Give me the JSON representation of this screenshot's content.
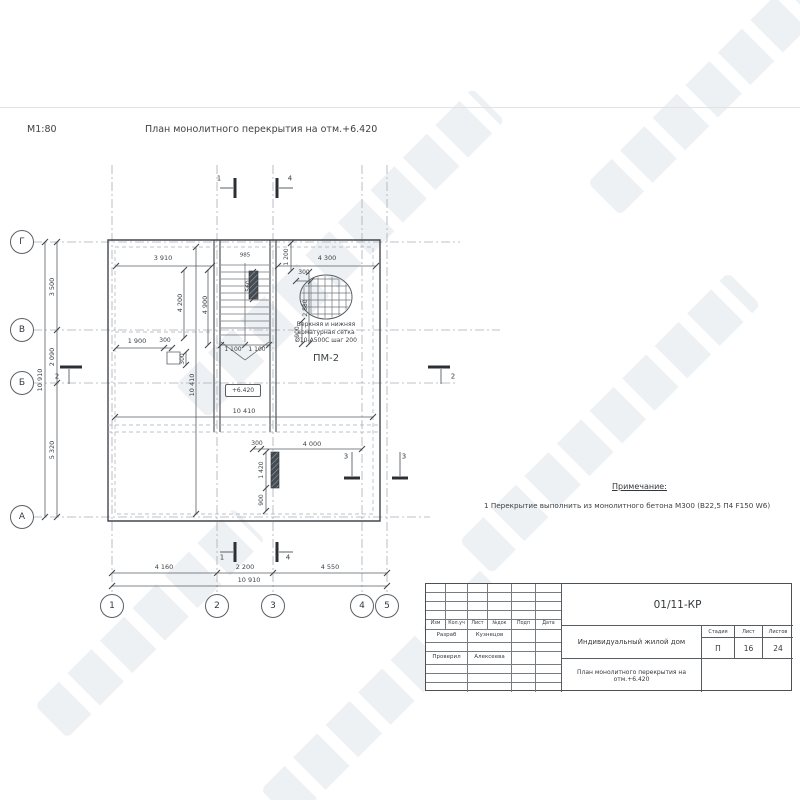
{
  "page": {
    "scale_label": "М1:80",
    "title": "План монолитного перекрытия на отм.+6.420"
  },
  "mesh_note": {
    "line1": "Верхняя и нижняя",
    "line2": "арматурная сетка",
    "line3": "Ø10-А500С шаг 200",
    "mark": "ПМ-2"
  },
  "elevation_mark": "+6.420",
  "notes": {
    "heading": "Примечание:",
    "item1": "1 Перекрытие выполнить из монолитного бетона М300 (В22,5 П4 F150 W6)"
  },
  "axes": {
    "left": [
      {
        "label": "Г",
        "x": 22,
        "y": 242
      },
      {
        "label": "В",
        "x": 22,
        "y": 330
      },
      {
        "label": "Б",
        "x": 22,
        "y": 383
      },
      {
        "label": "А",
        "x": 22,
        "y": 517
      }
    ],
    "bottom": [
      {
        "label": "1",
        "x": 112,
        "y": 606
      },
      {
        "label": "2",
        "x": 217,
        "y": 606
      },
      {
        "label": "3",
        "x": 273,
        "y": 606
      },
      {
        "label": "4",
        "x": 362,
        "y": 606
      },
      {
        "label": "5",
        "x": 387,
        "y": 606
      }
    ]
  },
  "labels": [
    {
      "t": "3 910",
      "x": 163,
      "y": 258
    },
    {
      "t": "4 300",
      "x": 327,
      "y": 258
    },
    {
      "t": "985",
      "x": 245,
      "y": 256,
      "s": 5.5
    },
    {
      "t": "4 900",
      "x": 205,
      "y": 305,
      "r": -90
    },
    {
      "t": "4 200",
      "x": 180,
      "y": 303,
      "r": -90
    },
    {
      "t": "1 200",
      "x": 287,
      "y": 257,
      "r": -90,
      "s": 6
    },
    {
      "t": "300",
      "x": 304,
      "y": 273,
      "s": 6
    },
    {
      "t": "560",
      "x": 249,
      "y": 286,
      "r": -90,
      "s": 6
    },
    {
      "t": "2 880",
      "x": 306,
      "y": 308,
      "r": -90,
      "s": 6
    },
    {
      "t": "900",
      "x": 298,
      "y": 332,
      "r": -90,
      "s": 6
    },
    {
      "t": "1 900",
      "x": 137,
      "y": 341
    },
    {
      "t": "300",
      "x": 165,
      "y": 341,
      "s": 6
    },
    {
      "t": "300",
      "x": 183,
      "y": 359,
      "r": -90,
      "s": 6
    },
    {
      "t": "1 100",
      "x": 233,
      "y": 350,
      "s": 6
    },
    {
      "t": "1 100",
      "x": 257,
      "y": 350,
      "s": 6
    },
    {
      "t": "10 410",
      "x": 192,
      "y": 385,
      "r": -90
    },
    {
      "t": "10 410",
      "x": 244,
      "y": 411
    },
    {
      "t": "300",
      "x": 257,
      "y": 444,
      "s": 6
    },
    {
      "t": "4 000",
      "x": 312,
      "y": 444
    },
    {
      "t": "1 420",
      "x": 262,
      "y": 470,
      "r": -90,
      "s": 6
    },
    {
      "t": "900",
      "x": 262,
      "y": 500,
      "r": -90,
      "s": 6
    },
    {
      "t": "4 160",
      "x": 164,
      "y": 567
    },
    {
      "t": "2 200",
      "x": 245,
      "y": 567
    },
    {
      "t": "4 550",
      "x": 330,
      "y": 567
    },
    {
      "t": "10 910",
      "x": 249,
      "y": 580
    },
    {
      "t": "3 500",
      "x": 52,
      "y": 287,
      "r": -90
    },
    {
      "t": "2 090",
      "x": 52,
      "y": 357,
      "r": -90
    },
    {
      "t": "5 320",
      "x": 52,
      "y": 450,
      "r": -90
    },
    {
      "t": "10 910",
      "x": 40,
      "y": 380,
      "r": -90
    },
    {
      "t": "1",
      "x": 219,
      "y": 179,
      "s": 7
    },
    {
      "t": "4",
      "x": 290,
      "y": 179,
      "s": 7
    },
    {
      "t": "1",
      "x": 222,
      "y": 558,
      "s": 7
    },
    {
      "t": "4",
      "x": 288,
      "y": 558,
      "s": 7
    },
    {
      "t": "2",
      "x": 57,
      "y": 377,
      "s": 7
    },
    {
      "t": "2",
      "x": 453,
      "y": 377,
      "s": 7
    },
    {
      "t": "3",
      "x": 346,
      "y": 457,
      "s": 7
    },
    {
      "t": "3",
      "x": 404,
      "y": 457,
      "s": 7
    },
    {
      "t": "Верхняя и нижняя",
      "x": 326,
      "y": 325,
      "s": 6
    },
    {
      "t": "арматурная сетка",
      "x": 326,
      "y": 333,
      "s": 6
    },
    {
      "t": "Ø10-А500С шаг 200",
      "x": 326,
      "y": 341,
      "s": 6
    },
    {
      "t": "ПМ-2",
      "x": 326,
      "y": 359,
      "s": 10
    }
  ],
  "stamp": {
    "doc_number": "01/11-КР",
    "object": "Индивидуальный жилой дом",
    "sheet_title": "План монолитного перекрытия на отм.+6.420",
    "headers": [
      "Изм",
      "Кол.уч",
      "Лист",
      "№док",
      "Подп",
      "Дата"
    ],
    "signature_rows": [
      {
        "role": "Разраб",
        "name": "Кузнецов"
      },
      {
        "role": "Проверил",
        "name": "Алексеева"
      }
    ],
    "stage_label": "Стадия",
    "sheet_label": "Лист",
    "sheets_label": "Листов",
    "stage": "П",
    "sheet_number": "16",
    "sheets_total": "24"
  }
}
